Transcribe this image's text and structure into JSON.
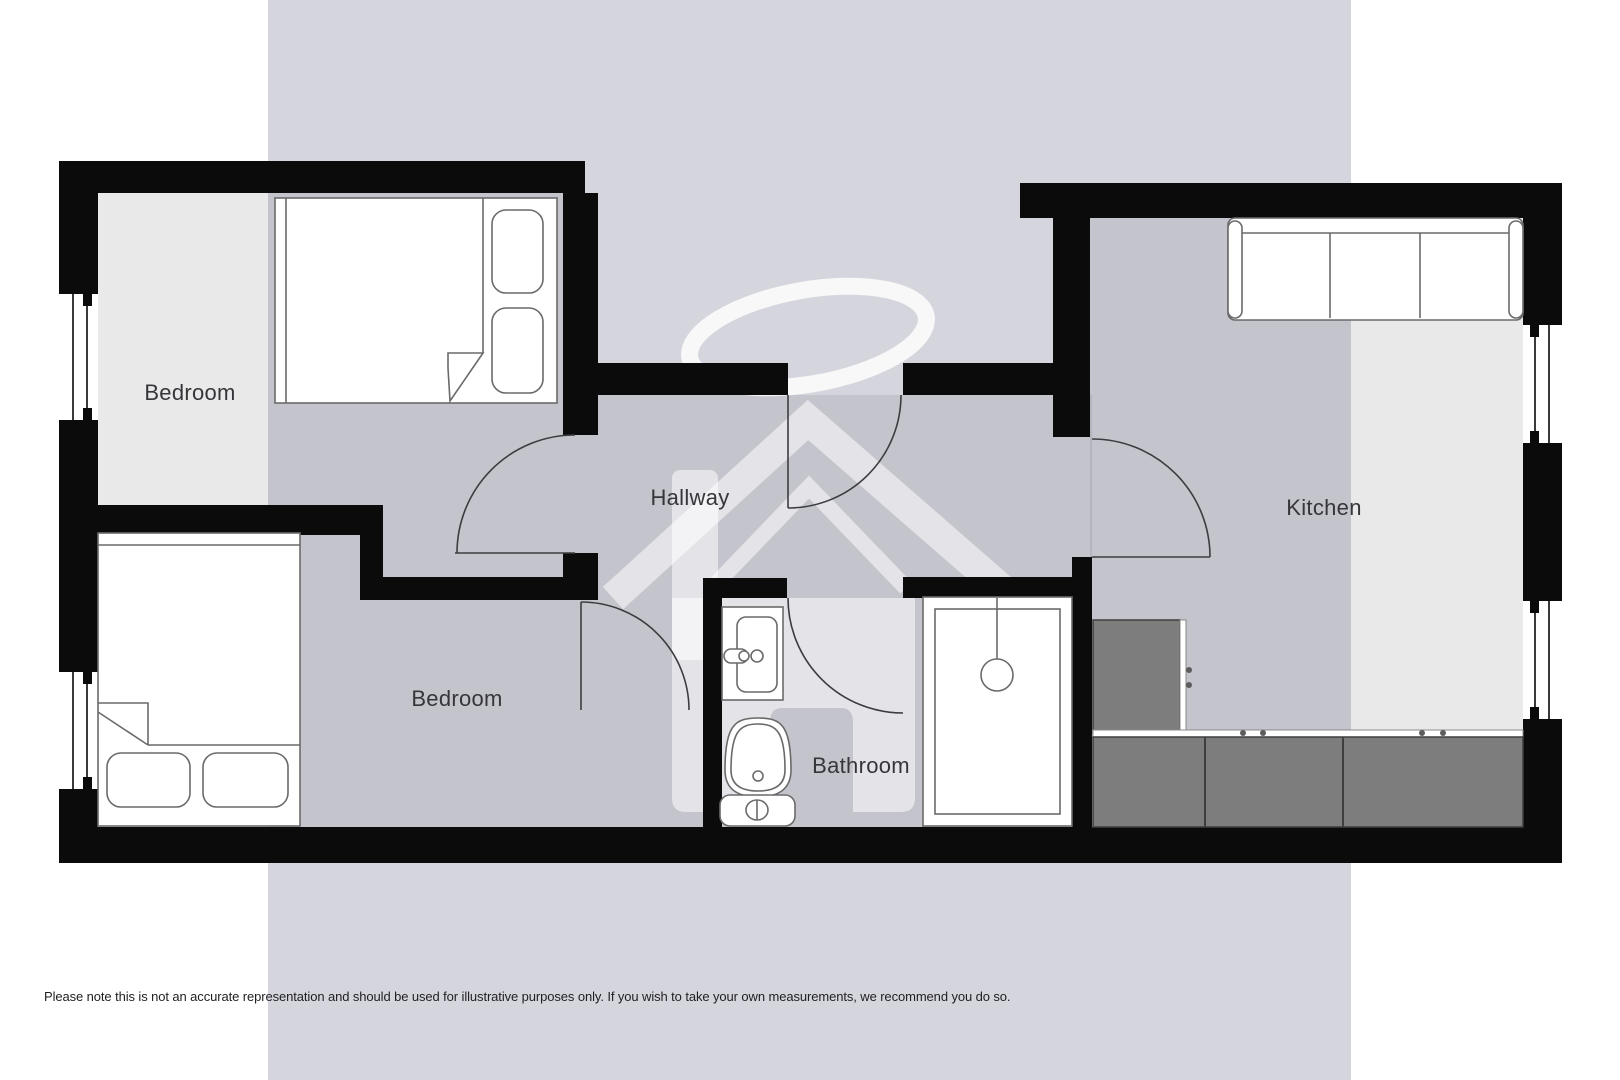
{
  "rooms": [
    {
      "id": "bedroom-top",
      "label": "Bedroom"
    },
    {
      "id": "bedroom-bottom",
      "label": "Bedroom"
    },
    {
      "id": "hallway",
      "label": "Hallway"
    },
    {
      "id": "bathroom",
      "label": "Bathroom"
    },
    {
      "id": "kitchen",
      "label": "Kitchen"
    }
  ],
  "fixtures": [
    "double-bed-icon",
    "double-bed-icon",
    "sofa-icon",
    "shower-icon",
    "sink-icon",
    "toilet-icon",
    "kitchen-counter",
    "door-arc",
    "window",
    "house-halo-watermark-icon"
  ],
  "disclaimer": "Please note this is not an accurate representation and should be used for illustrative purposes only. If you wish to take your own measurements, we recommend you do so.",
  "colors": {
    "wall": "#0b0b0b",
    "background_band": "#d5d5dd",
    "floor_overlay": "rgba(82,82,96,0.13)",
    "counter": "#7d7d7d",
    "furniture_outline": "#6a6a6a",
    "door_arc": "#3c3c40",
    "label_text": "#36363a",
    "disclaimer_text": "#1f1f22"
  }
}
